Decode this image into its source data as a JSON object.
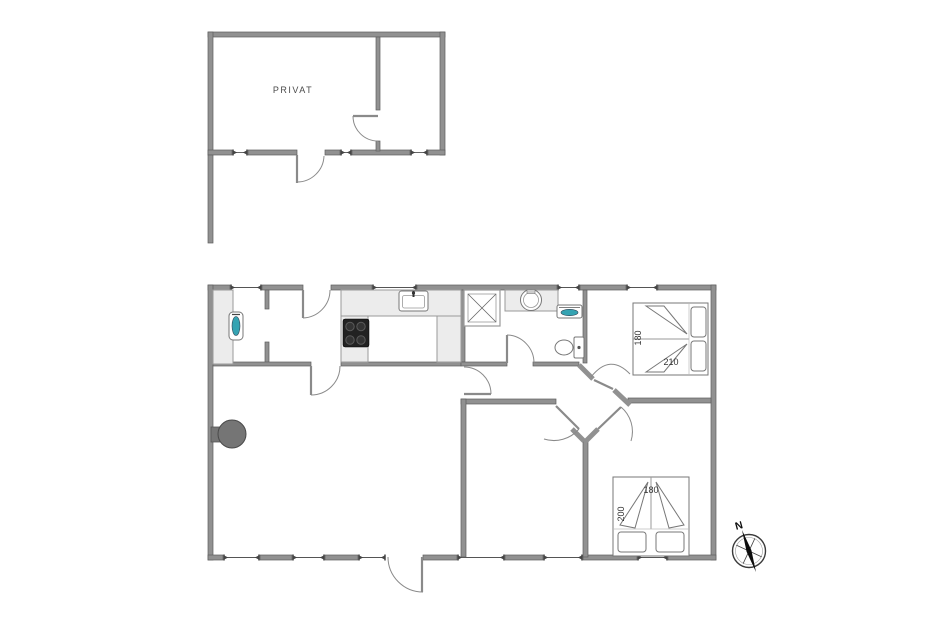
{
  "annex": {
    "room_label": "PRIVAT"
  },
  "bedrooms": {
    "northeast_bed": {
      "width_cm": "180",
      "length_cm": "210"
    },
    "southeast_bed": {
      "width_cm": "180",
      "length_cm": "200"
    }
  },
  "compass": {
    "north_label": "N"
  },
  "colors": {
    "wall_gray": "#919191",
    "counter_gray": "#ececec",
    "fixture_teal": "#35a3b2",
    "cooktop_black": "#222222",
    "wood_stove_gray": "#757575",
    "door_line_gray": "#8a8a8a",
    "background": "#ffffff"
  },
  "fixtures": [
    "wood-stove",
    "kitchen-counter",
    "cooktop",
    "kitchen-sink",
    "utility-counter",
    "utility-sink",
    "shower",
    "washbasin",
    "washing-machine",
    "toilet",
    "double-bed-northeast",
    "double-bed-southeast",
    "compass-rose"
  ]
}
